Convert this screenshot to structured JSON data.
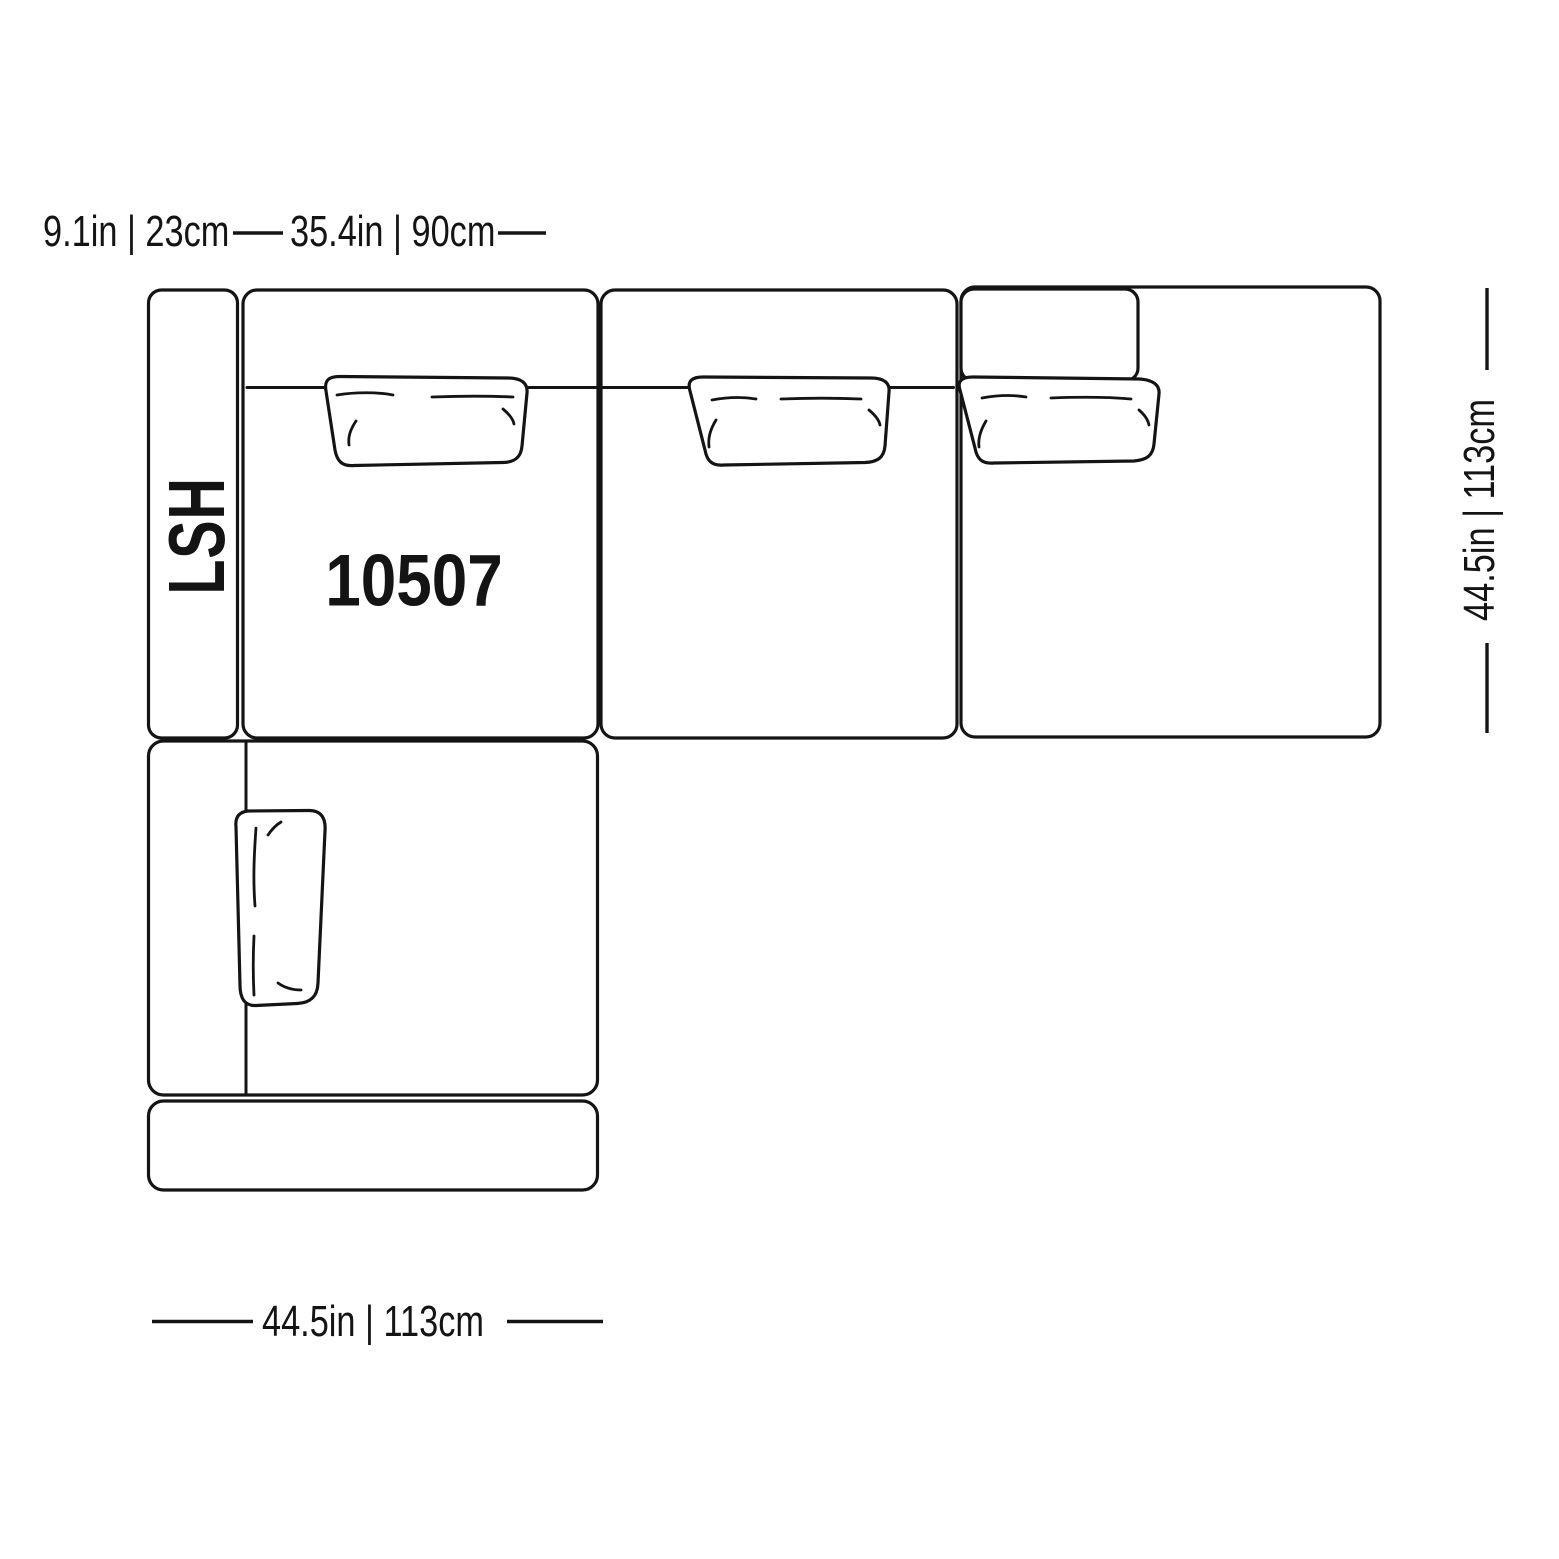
{
  "diagram": {
    "type": "sectional-sofa-top-view-dimension-diagram",
    "model_label": "10507",
    "orientation_label": "LSH",
    "dimensions": {
      "arm_width": "9.1in | 23cm",
      "seat_width": "35.4in | 90cm",
      "depth": "44.5in | 113cm",
      "chaise_width": "44.5in | 113cm"
    },
    "colors": {
      "line": "#141414",
      "background": "#ffffff"
    }
  }
}
